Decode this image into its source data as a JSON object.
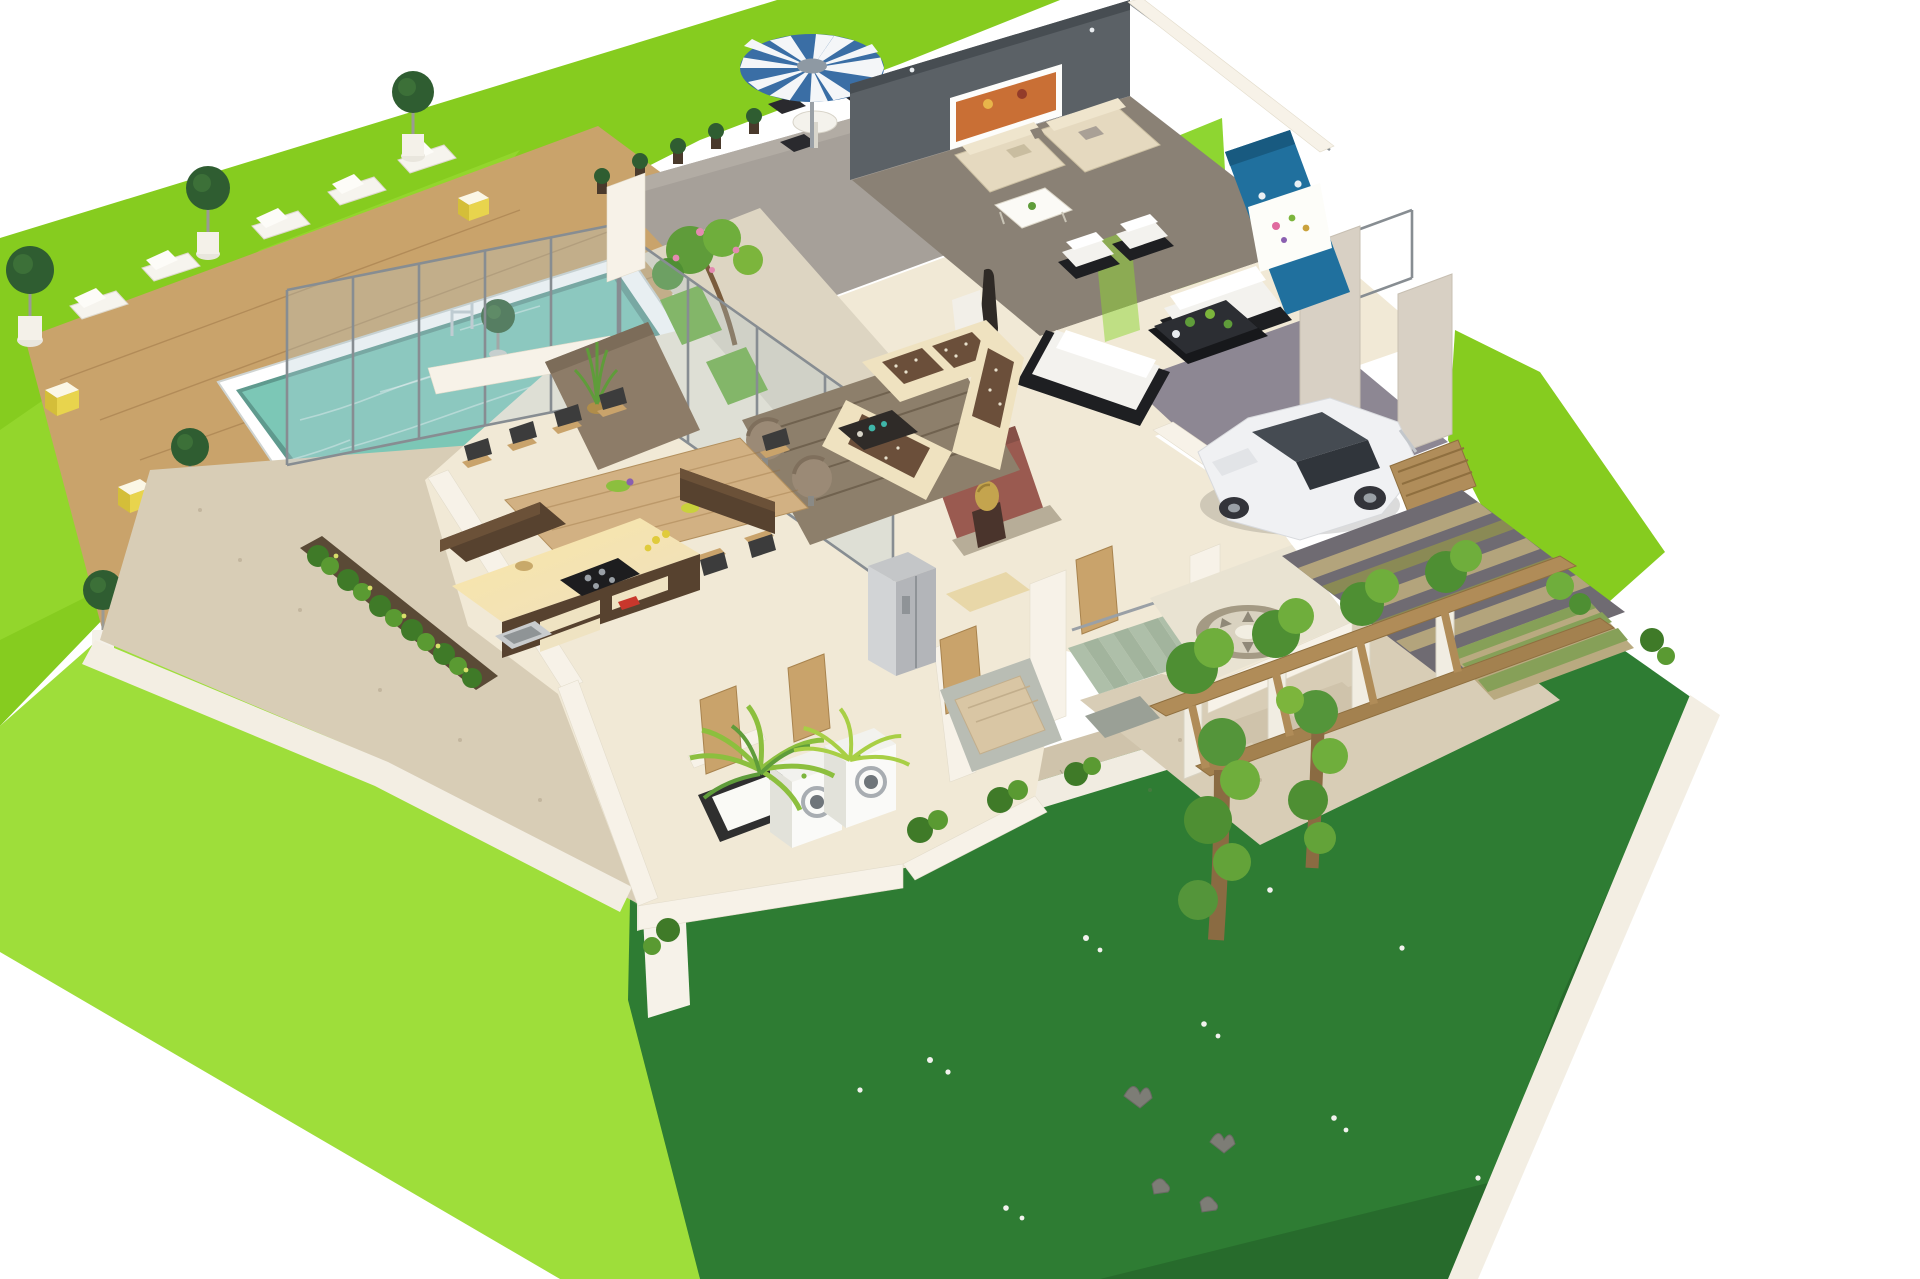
{
  "scene": {
    "title": "3D isometric cutaway floor-plan render of a modern villa",
    "style": "dollhouse axonometric view on white background, no roof, fully furnished",
    "areas": [
      {
        "name": "back-lawn",
        "description": "bright light-green manicured lawn wrapping the pool deck and patio"
      },
      {
        "name": "pool-deck",
        "description": "wooden plank sun deck with lounge chairs, topiary trees in white pots and yellow cube stools",
        "lounge_chairs": 5,
        "topiary_trees": 6,
        "yellow_stools": 3
      },
      {
        "name": "swimming-pool",
        "description": "rectangular pool with white coping and rippled teal water, chrome ladder"
      },
      {
        "name": "outdoor-patio",
        "description": "grey stone patio with blue-and-white striped parasol, round white table and four black wicker chairs, row of small potted plants, white steps to deck",
        "parasol_stripes": [
          "blue",
          "white"
        ],
        "chairs": 4
      },
      {
        "name": "living-room",
        "description": "lounge with beige corner sofas, white coffee table, charcoal feature wall with colourful artwork behind glass wall"
      },
      {
        "name": "formal-living-room",
        "description": "white sofa suite on dark bases around black coffee table with plants, teal-blue feature wall with floral art panel and spotlights, tall dark floor vase"
      },
      {
        "name": "family-lounge",
        "description": "cream sectional with brown chequered cushions, two taupe swivel chairs, dark coffee table on patterned brown rug, maroon display wall with golden bust sculpture"
      },
      {
        "name": "courtyard-garden",
        "description": "internal glass-walled garden with flowering tree, grass squares and pebble floor"
      },
      {
        "name": "dining-room",
        "description": "long light-wood dining table with nine dark-upholstered timber chairs, taupe feature wall, agave plant in brass pot",
        "dining_chairs": 9
      },
      {
        "name": "kitchen",
        "description": "L-shaped kitchen, dark walnut overhead cabinets, cream base units with warm under-cabinet glow, black hob, steel sink, double-door grey fridge"
      },
      {
        "name": "utility-room",
        "description": "two white front-loading washing machines and black-framed utility sink",
        "washing_machines": 2
      },
      {
        "name": "bathroom",
        "description": "small bath with tan tub and grey mosaic floor, timber doors"
      },
      {
        "name": "staircase",
        "description": "sage-green treads between white stringer walls with steel rail",
        "treads": 7
      },
      {
        "name": "garage",
        "description": "white hatchback car parked on grey floor beside slatted timber sideboard",
        "cars": 1
      },
      {
        "name": "entry-foyer",
        "description": "porch floor with circular stone mosaic medallion"
      },
      {
        "name": "pergola-driveway",
        "description": "white pergola columns with timber beams covered in climbing ivy over gravel path and striped paver driveway"
      },
      {
        "name": "front-lawn",
        "description": "deep-green lawn with scattered white daisies and four feeding pigeons, stone paver path along white boundary wall, palm shrubs",
        "birds": 4,
        "daisies": 14
      }
    ],
    "counts": {
      "lounge_chairs": 5,
      "topiary_trees": 6,
      "dining_chairs": 9,
      "washing_machines": 2,
      "stair_treads": 7,
      "pergola_posts": 4,
      "birds": 4
    }
  },
  "palette": {
    "lawn_light": "#86cc1f",
    "lawn_light_hi": "#9ede3a",
    "lawn_dark": "#2e7c33",
    "deck_wood": "#c9a36b",
    "pool_rim": "#ffffff",
    "pool_water": "#7cc7b6",
    "patio_floor": "#a6a099",
    "umbrella_blue": "#3a6ea5",
    "gravel": "#d8cdb6",
    "paver": "#cfc3ab",
    "house_floor": "#f1e9d6",
    "floor_gray": "#8a8175",
    "wall_white": "#f7f2e8",
    "accent_gray_wall": "#5b6166",
    "accent_blue_wall": "#20709e",
    "accent_maroon_wall": "#9a5a50",
    "kitchen_dark": "#57422f",
    "kitchen_glow": "#f6dfa0",
    "sofa_cream": "#e5d9bf",
    "sofa_white": "#f3f2ee",
    "sofa_black": "#1e1f22",
    "wood_table": "#d2b183",
    "stairs_sage": "#aebfa9",
    "garage_floor": "#8d8793",
    "car_white": "#f0f1f3",
    "foliage": "#5f9c3a",
    "driveway": "#6f6b72",
    "rug_brown": "#8d7f6b"
  }
}
